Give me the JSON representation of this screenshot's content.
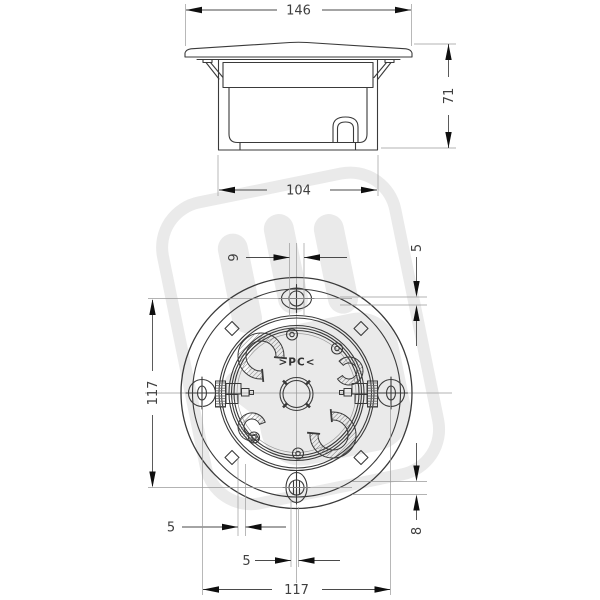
{
  "drawing": {
    "side_view": {
      "lid_width": "146",
      "height": "71",
      "body_width": "104"
    },
    "plan_view": {
      "slot_offset": "9",
      "top_right_offset": "5",
      "bolt_spacing_v": "117",
      "bottom_left_offset": "5",
      "bottom_center_offset": "5",
      "bolt_spacing_h": "117",
      "bottom_right_offset": "8",
      "material_label": ">PC<"
    },
    "colors": {
      "line": "#3a3a3a",
      "dimension_text": "#3f3f3f",
      "arrow": "#0f0f0f",
      "watermark": "#eaeaea",
      "background": "#ffffff"
    }
  }
}
